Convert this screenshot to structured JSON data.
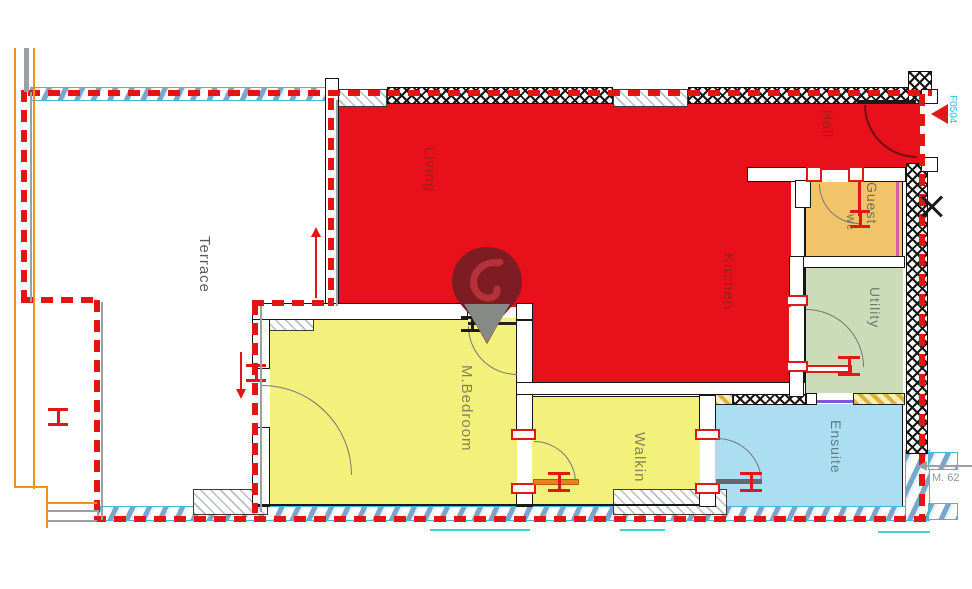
{
  "app": {
    "type": "floor-plan-viewer"
  },
  "rooms": {
    "terrace": {
      "label": "Terrace"
    },
    "living": {
      "label": "Living"
    },
    "kitchen": {
      "label": "Kitchen"
    },
    "hall": {
      "label": "Hall"
    },
    "guest_wc": {
      "label": "Guest",
      "sublabel": "Wc"
    },
    "utility": {
      "label": "Utility"
    },
    "m_bedroom": {
      "label": "M.Bedroom"
    },
    "walkin": {
      "label": "Walkin"
    },
    "ensuite": {
      "label": "Ensuite"
    }
  },
  "annotations": {
    "unit_code": {
      "text": "F0504",
      "color": "#25c2d6"
    },
    "measure": {
      "text": "M. 62",
      "color": "#8f9599"
    }
  },
  "palette": {
    "living_red": "#e8111b",
    "bedroom_yellow": "#f4f07c",
    "guest_orange": "#f2c469",
    "utility_green": "#ccdcb8",
    "ensuite_blue": "#aadef0",
    "boundary_dashed_red": "#e01515",
    "label_red_rooms": "#a11d15",
    "label_neutral": "#73735a",
    "pin_maroon": "#7e1c23"
  },
  "icons": {
    "marker": "location-pin",
    "entry_arrow": "red-left-triangle",
    "section_cross": "x-marker"
  }
}
